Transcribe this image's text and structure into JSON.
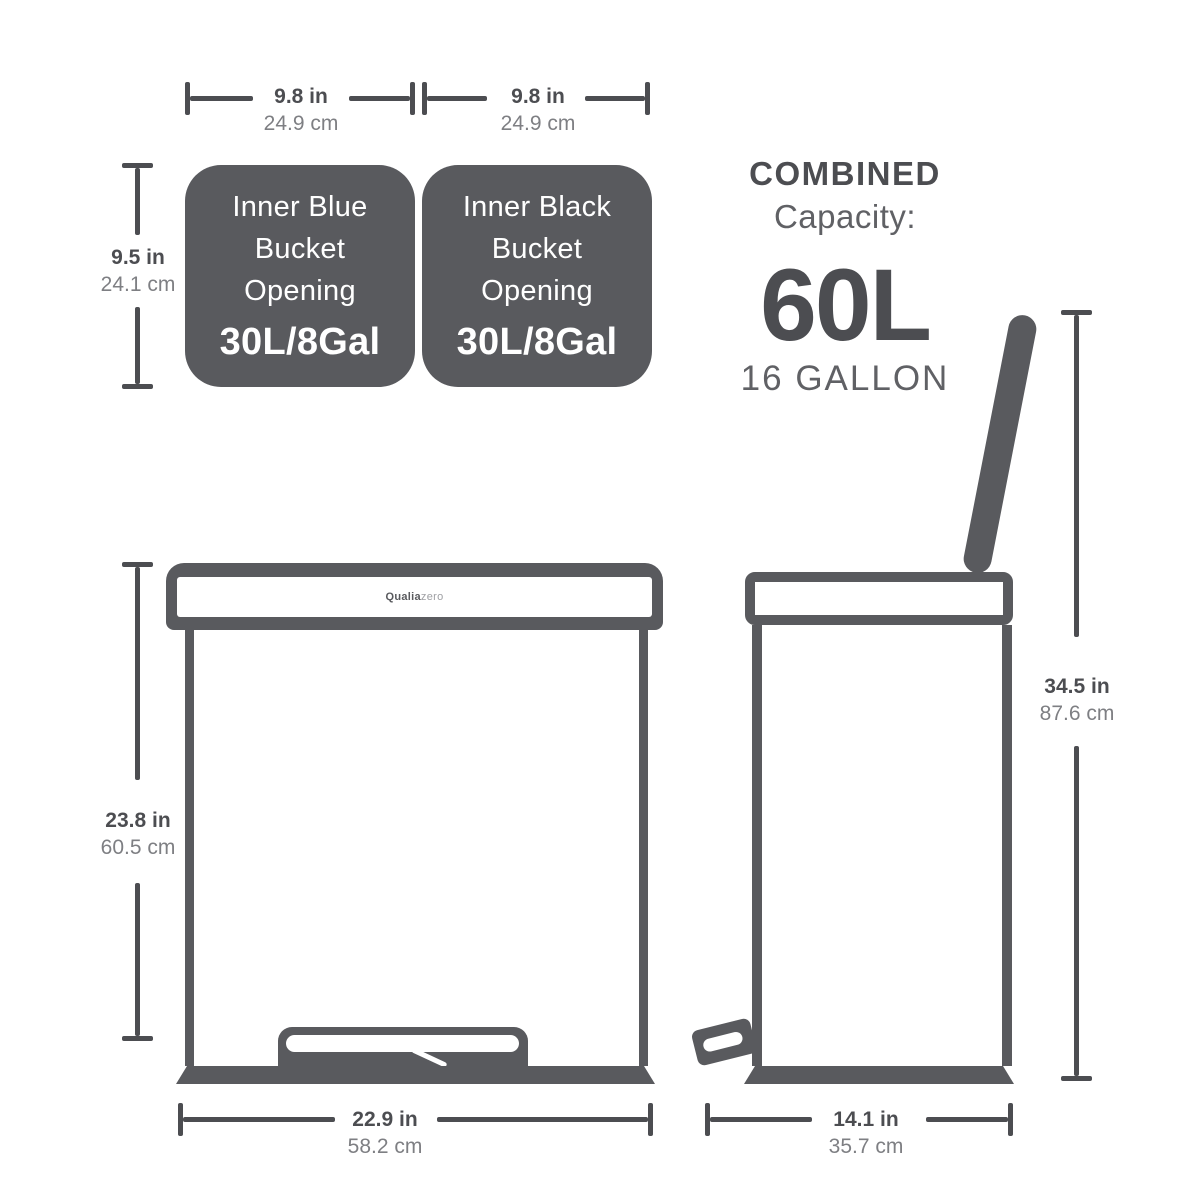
{
  "colors": {
    "ink": "#4c4d51",
    "panel": "#595a5e",
    "muted": "#7e7f83",
    "soft": "#606165",
    "brand_light": "#9fa0a4",
    "bg": "#ffffff"
  },
  "buckets": {
    "left": {
      "line1": "Inner Blue",
      "line2": "Bucket",
      "line3": "Opening",
      "capacity": "30L/8Gal"
    },
    "right": {
      "line1": "Inner Black",
      "line2": "Bucket",
      "line3": "Opening",
      "capacity": "30L/8Gal"
    },
    "width_left": {
      "inches": "9.8 in",
      "cm": "24.9 cm"
    },
    "width_right": {
      "inches": "9.8 in",
      "cm": "24.9 cm"
    },
    "height": {
      "inches": "9.5 in",
      "cm": "24.1 cm"
    }
  },
  "combined": {
    "title": "COMBINED",
    "subtitle": "Capacity:",
    "value": "60L",
    "gallons": "16 GALLON"
  },
  "front": {
    "brand_bold": "Qualia",
    "brand_light": "zero",
    "height": {
      "inches": "23.8 in",
      "cm": "60.5 cm"
    },
    "width": {
      "inches": "22.9 in",
      "cm": "58.2 cm"
    }
  },
  "side": {
    "height": {
      "inches": "34.5 in",
      "cm": "87.6 cm"
    },
    "width": {
      "inches": "14.1 in",
      "cm": "35.7 cm"
    }
  }
}
